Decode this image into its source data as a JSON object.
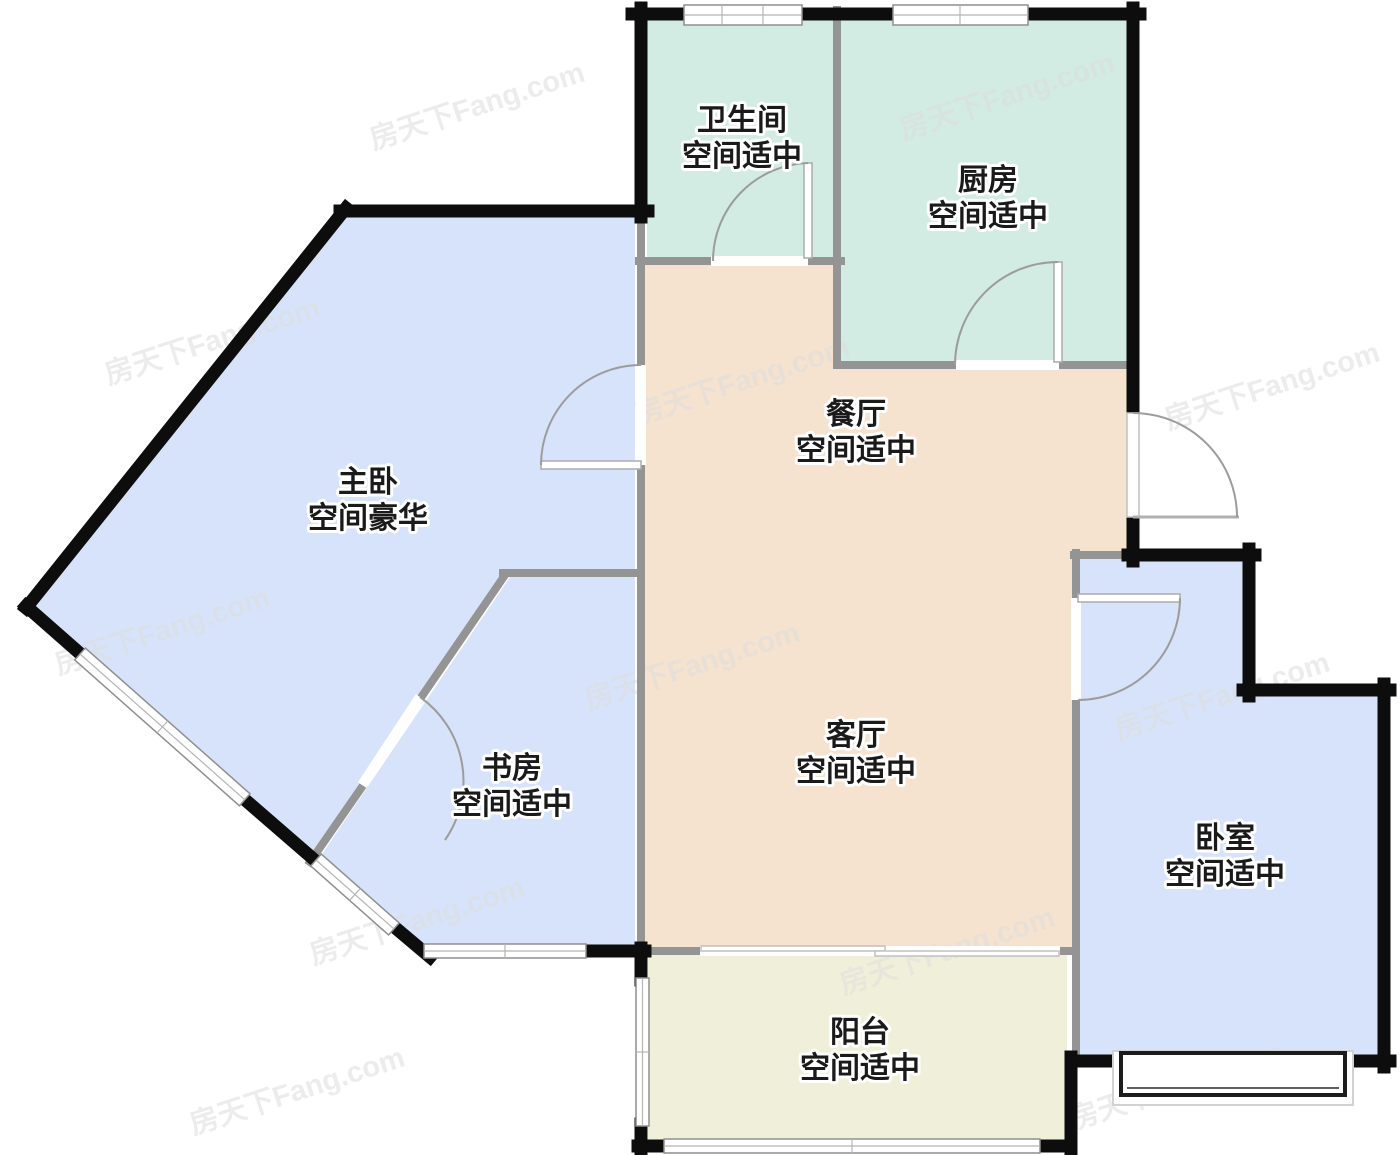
{
  "watermark": {
    "text": "房天下Fang.com"
  },
  "colors": {
    "exterior_wall": "#0d0d0d",
    "interior_wall": "#949494",
    "wet_room": "#d2ebe3",
    "hall": "#f5e2cf",
    "bedroom": "#d7e3fa",
    "balcony": "#f0f0da",
    "label_text": "#1a1a1a",
    "watermark_gray": "#dedede"
  },
  "rooms": [
    {
      "id": "bathroom",
      "name": "卫生间",
      "assessment": "空间适中"
    },
    {
      "id": "kitchen",
      "name": "厨房",
      "assessment": "空间适中"
    },
    {
      "id": "dining",
      "name": "餐厅",
      "assessment": "空间适中"
    },
    {
      "id": "master_bedroom",
      "name": "主卧",
      "assessment": "空间豪华"
    },
    {
      "id": "study",
      "name": "书房",
      "assessment": "空间适中"
    },
    {
      "id": "living",
      "name": "客厅",
      "assessment": "空间适中"
    },
    {
      "id": "bedroom",
      "name": "卧室",
      "assessment": "空间适中"
    },
    {
      "id": "balcony",
      "name": "阳台",
      "assessment": "空间适中"
    }
  ]
}
